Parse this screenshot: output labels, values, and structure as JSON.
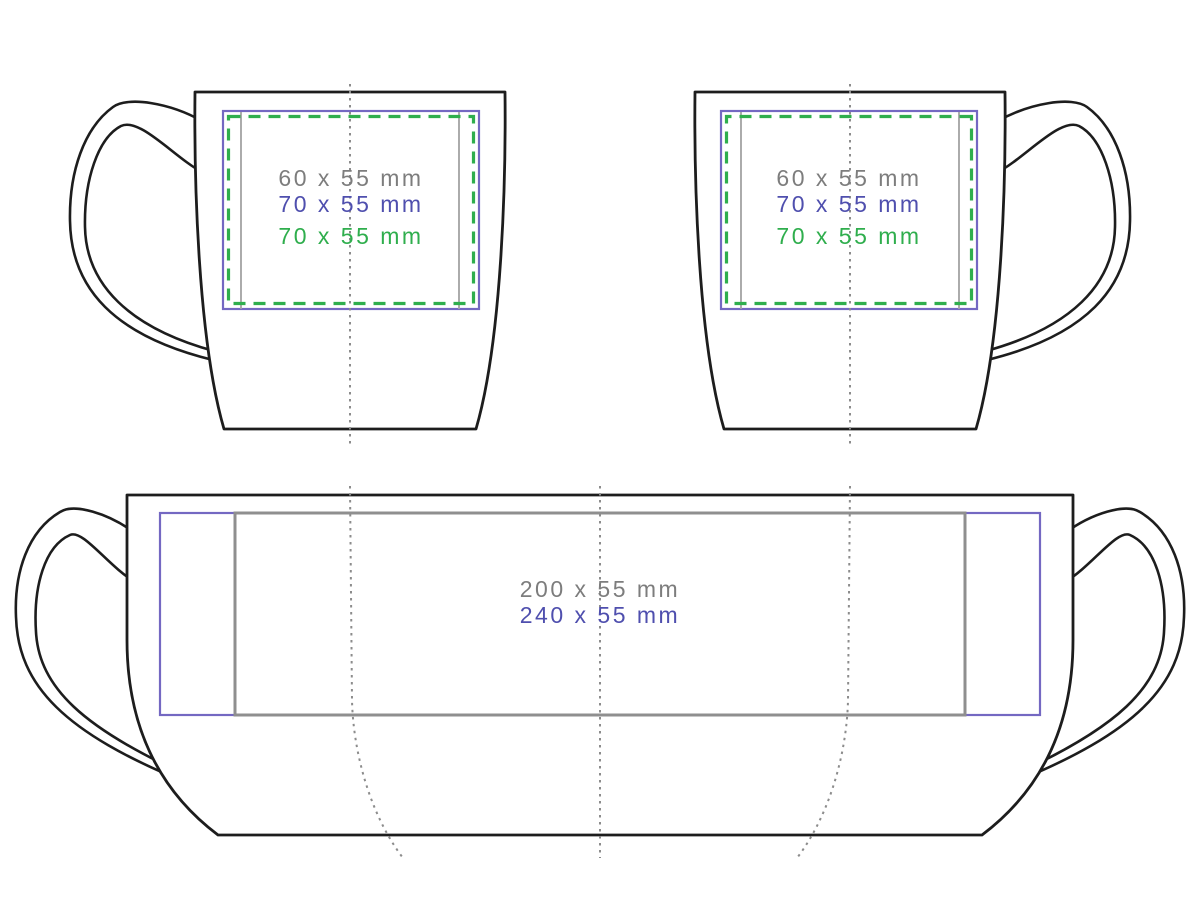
{
  "colors": {
    "outline": "#1d1d1d",
    "plate-purple": "#7468c2",
    "plate-gray": "#8f8f8f",
    "plate-gray-light": "#a2a2a2",
    "text-gray": "#7d7d7d",
    "text-blue": "#4f4fae",
    "green": "#2fae4d",
    "dotted-line": "#8c8c8c"
  },
  "views": {
    "side_left": {
      "labels": [
        {
          "label": "60 x 55 mm",
          "color": "gray"
        },
        {
          "label": "70 x 55 mm",
          "color": "blue"
        },
        {
          "label": "70 x 55 mm",
          "color": "green"
        }
      ]
    },
    "side_right": {
      "labels": [
        {
          "label": "60 x 55 mm",
          "color": "gray"
        },
        {
          "label": "70 x 55 mm",
          "color": "blue"
        },
        {
          "label": "70 x 55 mm",
          "color": "green"
        }
      ]
    },
    "wrap": {
      "labels": [
        {
          "label": "200 x 55 mm",
          "color": "gray"
        },
        {
          "label": "240 x 55 mm",
          "color": "blue"
        }
      ]
    }
  }
}
